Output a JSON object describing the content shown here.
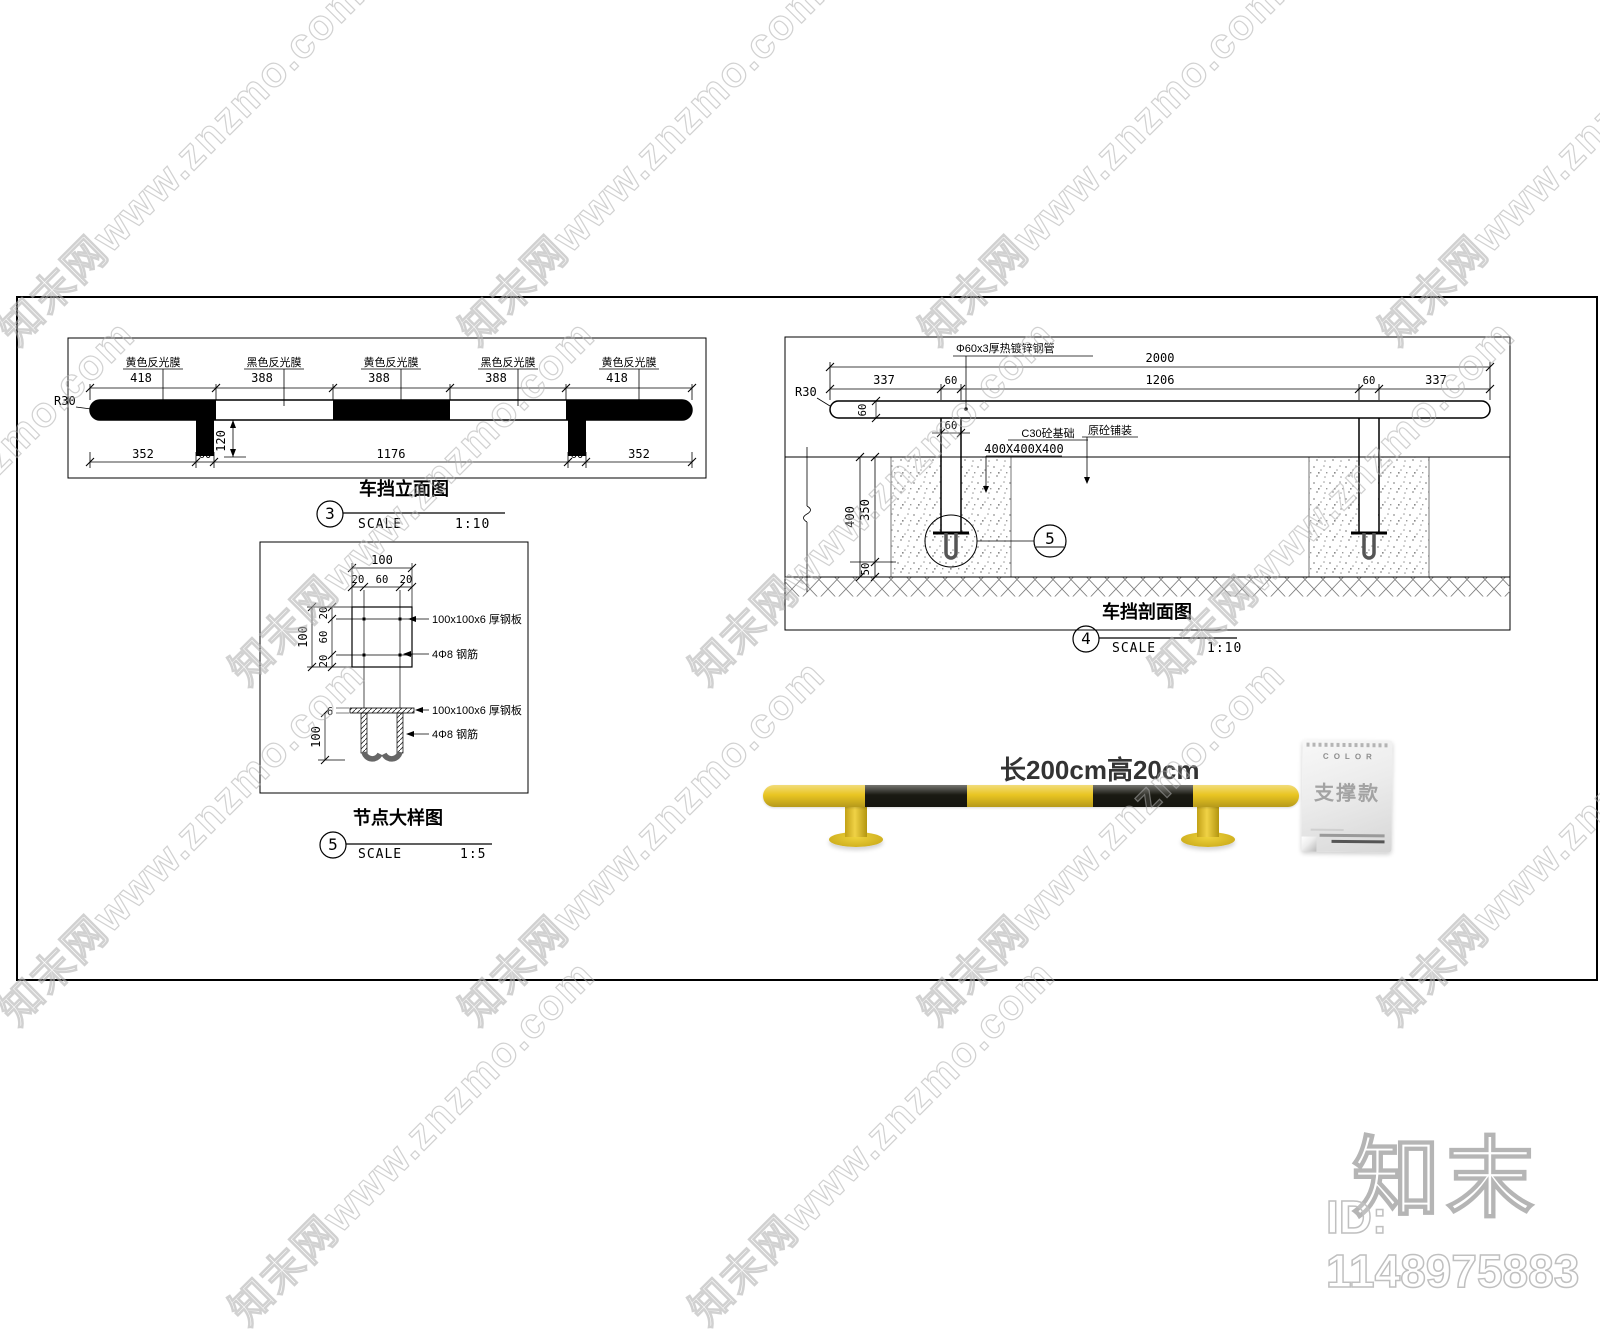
{
  "watermark": {
    "tile_text": "知末网www.znzmo.com",
    "logo_text": "知末",
    "id_text": "ID: 1148975883"
  },
  "elevation": {
    "title": "车挡立面图",
    "callout_number": "3",
    "scale_label": "SCALE",
    "scale_value": "1:10",
    "film_labels": [
      "黄色反光膜",
      "黑色反光膜",
      "黄色反光膜",
      "黑色反光膜",
      "黄色反光膜"
    ],
    "segment_dims": [
      "418",
      "388",
      "388",
      "388",
      "418"
    ],
    "end_radius": "R30",
    "leg_drop_dim": "120",
    "bottom_dims": [
      "352",
      "60",
      "1176",
      "60",
      "352"
    ]
  },
  "section": {
    "title": "车挡剖面图",
    "callout_number": "4",
    "scale_label": "SCALE",
    "scale_value": "1:10",
    "pipe_label": "Φ60x3厚热镀锌钢管",
    "overall_dim": "2000",
    "span_dims": [
      "337",
      "60",
      "1206",
      "60",
      "337"
    ],
    "end_radius": "R30",
    "pipe_height_dim": "60",
    "leg_width_dim": "60",
    "foundation_label": "C30砼基础",
    "foundation_size": "400X400X400",
    "pavement_label": "原砼铺装",
    "depth_total": "400",
    "depth_upper": "350",
    "depth_lower": "50",
    "detail_bubble": "5"
  },
  "node_detail": {
    "title": "节点大样图",
    "callout_number": "5",
    "scale_label": "SCALE",
    "scale_value": "1:5",
    "plan_width": "100",
    "plan_width_dims": [
      "20",
      "60",
      "20"
    ],
    "plan_height": "100",
    "plan_height_dims": [
      "20",
      "60",
      "20"
    ],
    "plate_label": "100x100x6 厚钢板",
    "rebar_label": "4Φ8 钢筋",
    "plate_thickness_dim": "6",
    "anchor_depth_dim": "100"
  },
  "photo": {
    "caption": "长200cm高20cm"
  },
  "tag": {
    "header": "COLOR",
    "title": "支撑款"
  },
  "colors": {
    "bollard_yellow": "#e9c522",
    "bollard_black": "#1a1a12"
  }
}
